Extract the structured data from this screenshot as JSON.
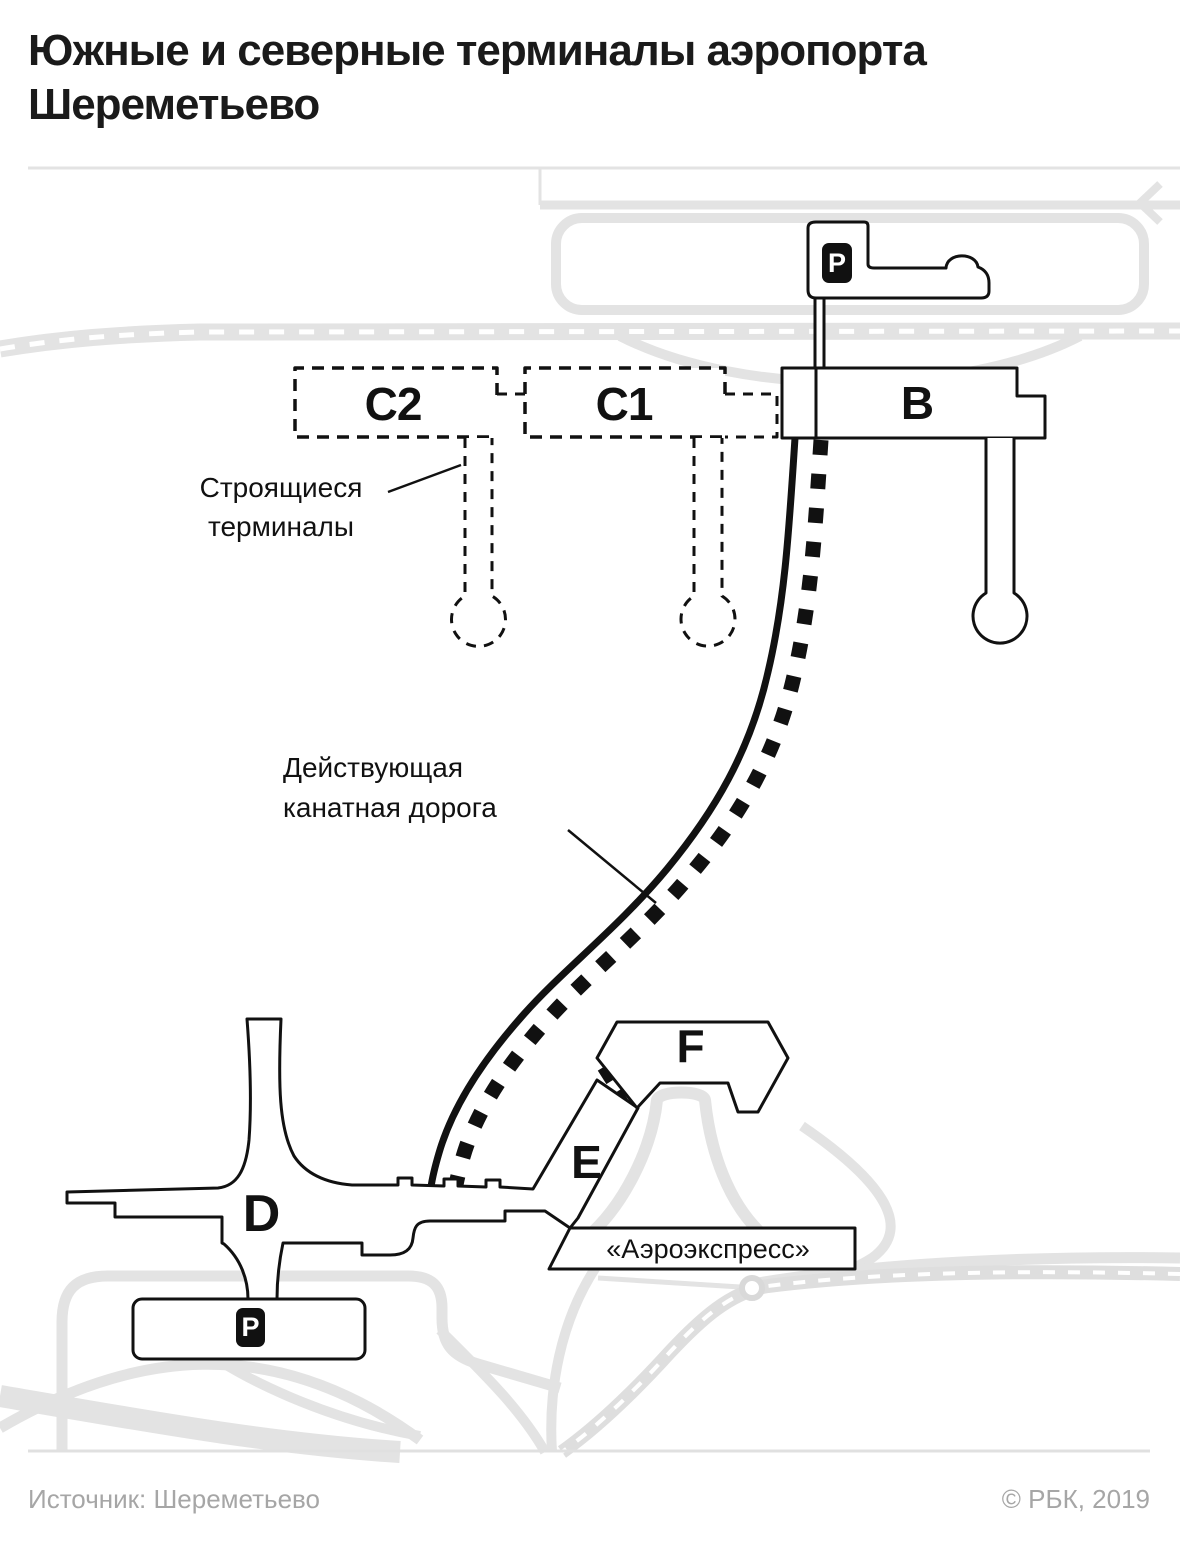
{
  "title": {
    "line1": "Южные и северные терминалы аэропорта",
    "line2": "Шереметьево"
  },
  "map": {
    "terminals": {
      "c2": "C2",
      "c1": "C1",
      "b": "B",
      "d": "D",
      "e": "E",
      "f": "F"
    },
    "parking_badge": "P",
    "labels": {
      "under_construction_line1": "Строящиеся",
      "under_construction_line2": "терминалы",
      "cable_car_line1": "Действующая",
      "cable_car_line2": "канатная дорога",
      "aeroexpress": "«Аэроэкспресс»"
    },
    "colors": {
      "ink": "#111111",
      "road_gray": "#e3e3e3",
      "footer_gray": "#a6a6a6"
    }
  },
  "footer": {
    "source": "Источник: Шереметьево",
    "copyright": "© РБК, 2019"
  }
}
